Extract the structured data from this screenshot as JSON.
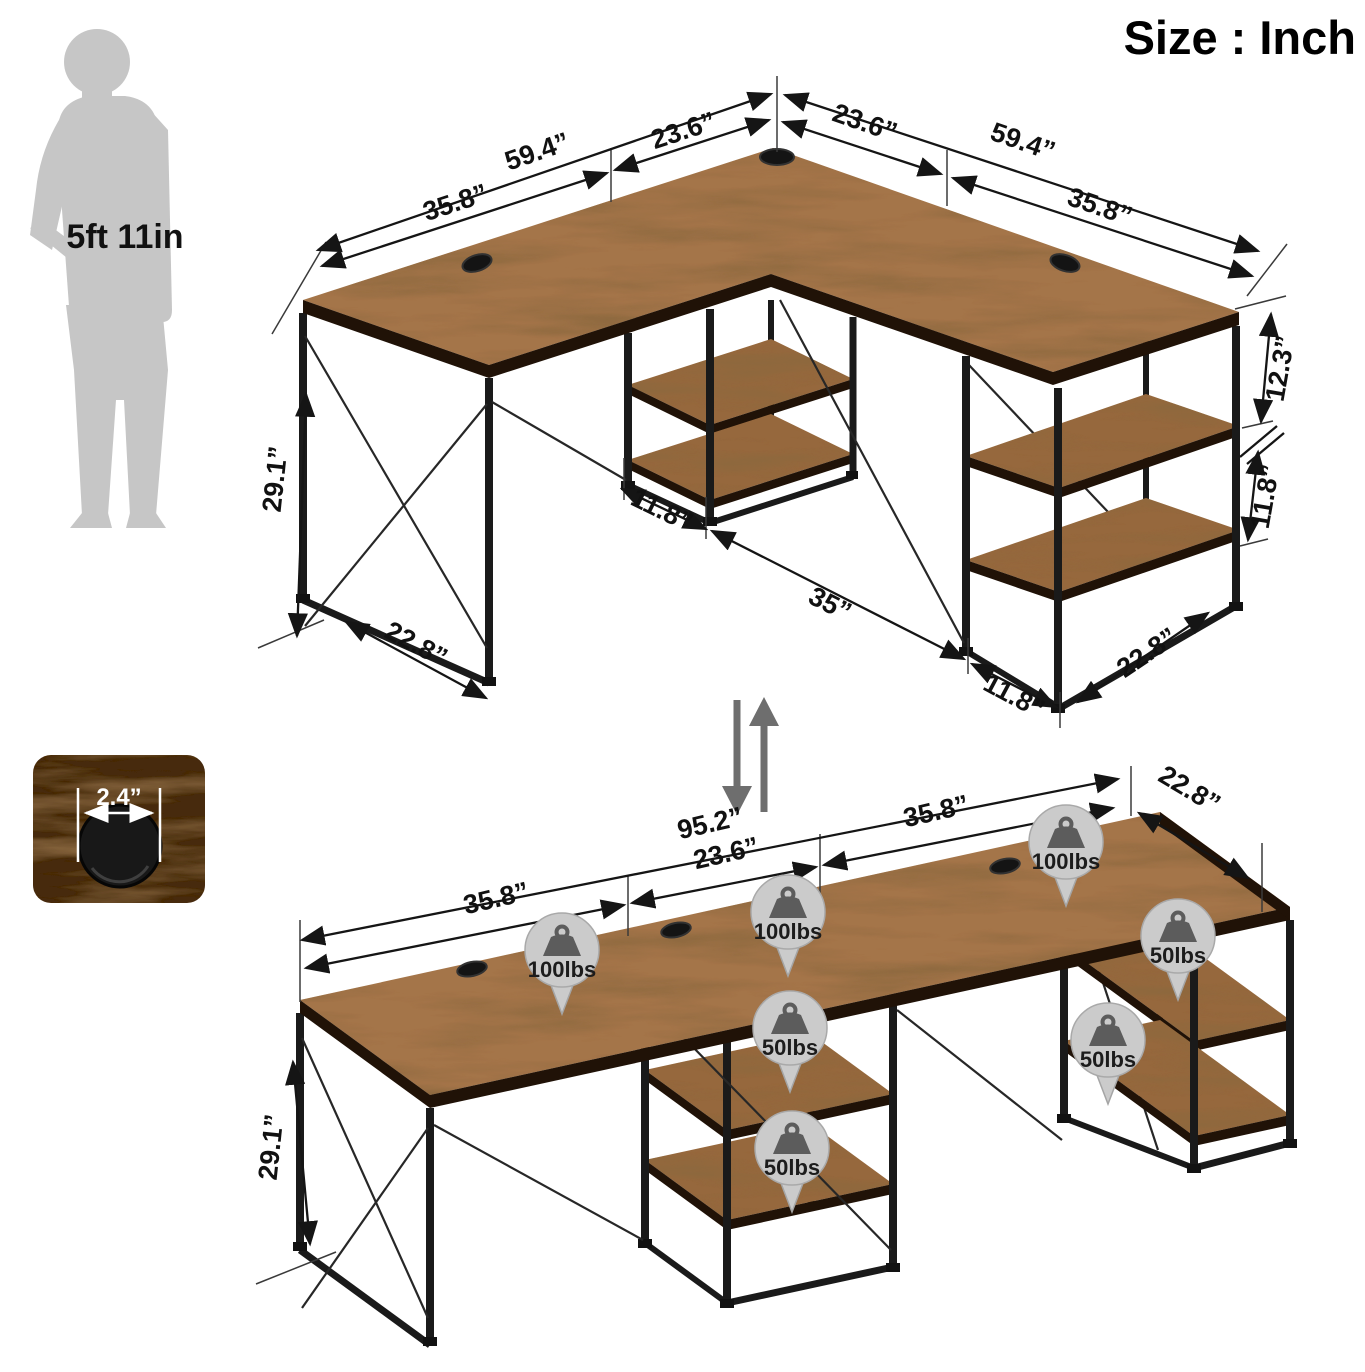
{
  "title": "Size : Inch",
  "reference_figure": {
    "height_label": "5ft 11in"
  },
  "grommet_detail": {
    "diameter": "2.4”"
  },
  "l_config": {
    "left_wing": {
      "total": "59.4”",
      "front": "35.8”",
      "corner": "23.6”"
    },
    "right_wing": {
      "corner": "23.6”",
      "total": "59.4”",
      "front": "35.8”"
    },
    "height": "29.1”",
    "right_shelf": {
      "top_gap": "12.3”",
      "shelf_gap": "11.8”"
    },
    "footprint": {
      "left_depth": "22.8”",
      "mid_shelf": "11.8”",
      "clearance": "35”",
      "right_shelf": "11.8”",
      "right_depth": "22.8”"
    }
  },
  "long_config": {
    "total": "95.2”",
    "left": "35.8”",
    "middle": "23.6”",
    "right": "35.8”",
    "depth": "22.8”",
    "height": "29.1”",
    "badges": [
      "100lbs",
      "100lbs",
      "100lbs",
      "50lbs",
      "50lbs",
      "50lbs",
      "50lbs"
    ]
  },
  "colors": {
    "wood": "#a4754a",
    "frame": "#1a1a1a",
    "badge_fill": "#cbcbcb",
    "silhouette": "#c6c6c6",
    "dimension_ink": "#151515"
  }
}
